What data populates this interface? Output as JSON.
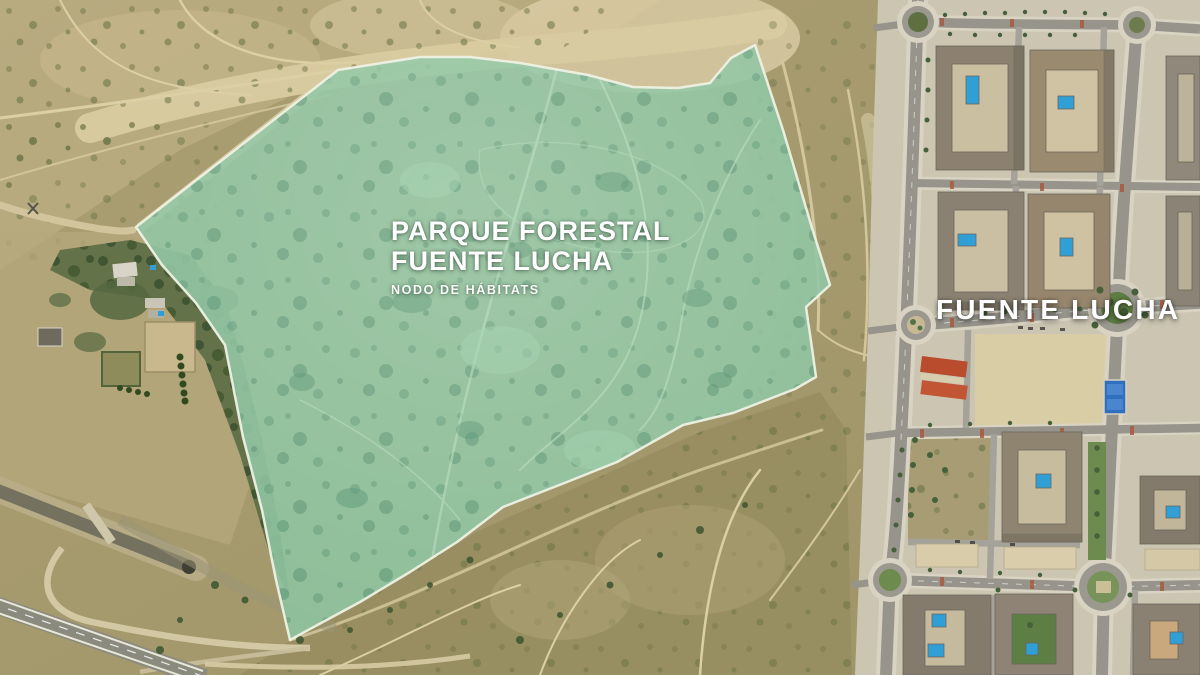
{
  "labels": {
    "park_title_line1": "PARQUE FORESTAL",
    "park_title_line2": "FUENTE LUCHA",
    "park_subtitle": "NODO DE HÁBITATS",
    "district_label": "FUENTE LUCHA"
  },
  "colors": {
    "park_fill": "#8dc4a1",
    "park_border": "#eef1e4",
    "label_text": "#ffffff",
    "scrubland": "#a89b6e",
    "sand_path": "#d6c89e",
    "woodland": "#566942",
    "urban_ground": "#ccc5b2",
    "road_asphalt": "#96948b",
    "pool_blue": "#2f9fd6",
    "red_roof": "#b94c2d"
  },
  "park_overlay": {
    "polygon_points": "136,227 338,70 420,57 470,57 520,63 588,75 633,87 678,88 710,83 731,58 755,45 783,130 812,228 830,285 806,307 812,348 816,377 795,389 733,413 683,425 617,462 567,482 503,507 457,542 410,572 360,602 310,629 290,640 276,580 262,510 243,437 225,345 196,303 162,265"
  }
}
